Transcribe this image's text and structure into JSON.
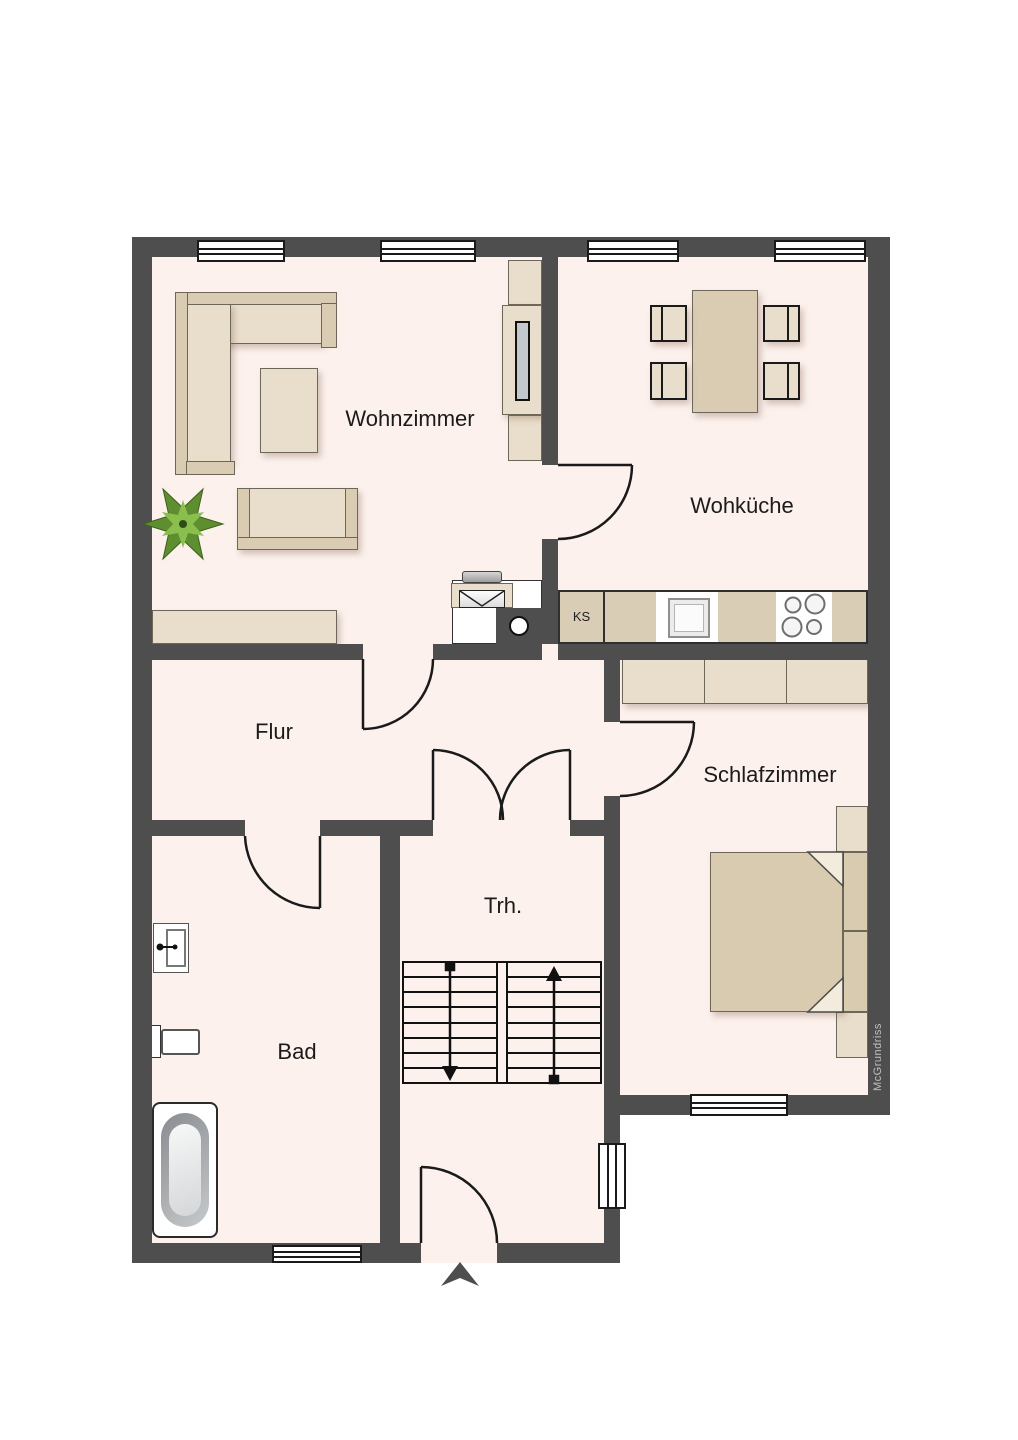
{
  "plan": {
    "watermark": "McGrundriss",
    "rooms": [
      {
        "key": "wohnzimmer",
        "label": "Wohnzimmer"
      },
      {
        "key": "wohkueche",
        "label": "Wohküche"
      },
      {
        "key": "flur",
        "label": "Flur"
      },
      {
        "key": "schlafzimmer",
        "label": "Schlafzimmer"
      },
      {
        "key": "treppenhaus",
        "label": "Trh."
      },
      {
        "key": "bad",
        "label": "Bad"
      }
    ],
    "kitchen": {
      "fridge_label": "KS"
    },
    "colors": {
      "wall": "#4e4e4e",
      "floor": "#fcf1ed",
      "furniture_light": "#e9decb",
      "furniture_dark": "#d9ccb3",
      "bed": "#d9cbb0",
      "plant_green": "#5e8e2f"
    }
  }
}
